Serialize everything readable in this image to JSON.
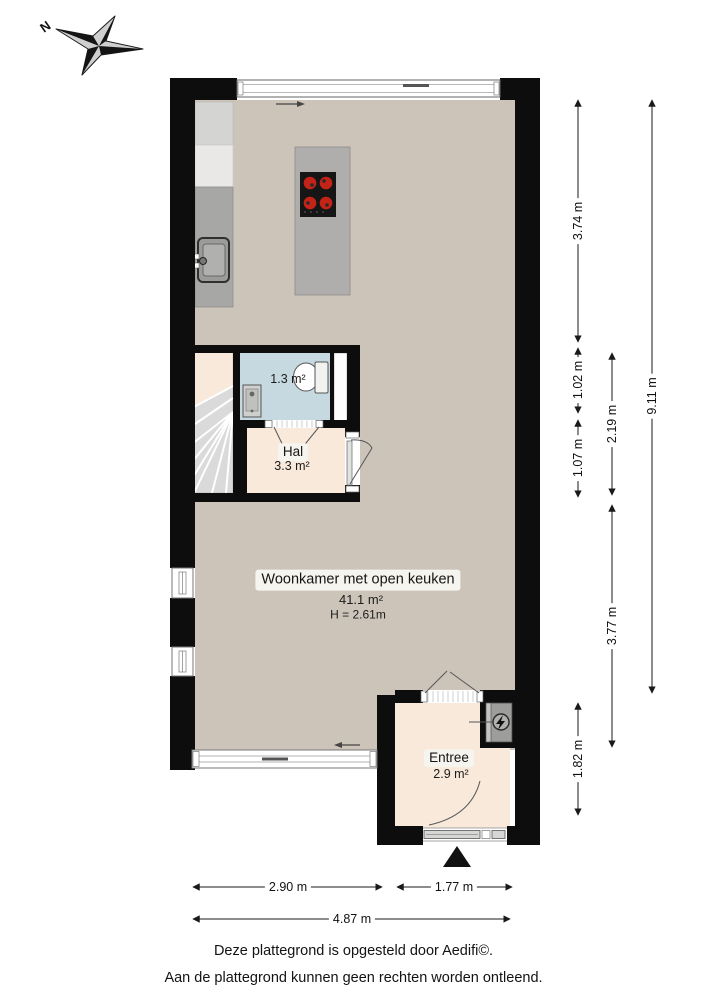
{
  "compass": {
    "north": "N"
  },
  "plan": {
    "rooms": {
      "woonkamer": {
        "label": "Woonkamer met open keuken",
        "area": "41.1 m²",
        "ceiling_height": "H = 2.61m"
      },
      "hal": {
        "label": "Hal",
        "area": "3.3 m²"
      },
      "toilet": {
        "area": "1.3 m²"
      },
      "entree": {
        "label": "Entree",
        "area": "2.9 m²"
      }
    },
    "fixtures": [
      "cooktop-island",
      "kitchen-sink",
      "kitchen-counter",
      "toilet",
      "hand-basin",
      "winder-stairs",
      "meter-cupboard",
      "entrance-marker"
    ],
    "colors": {
      "wall": "#0d0d0d",
      "floor_living": "#ccc3b9",
      "floor_hall": "#f8e9da",
      "floor_toilet": "#c6d9e0",
      "stairs": "#dadada",
      "counter": "#a7a7a5",
      "burner_red": "#c42318"
    }
  },
  "dimensions": {
    "right": [
      {
        "label": "3.74 m"
      },
      {
        "label": "1.02 m"
      },
      {
        "label": "1.07 m"
      },
      {
        "label": "1.82 m"
      },
      {
        "label": "2.19 m"
      },
      {
        "label": "3.77 m"
      },
      {
        "label": "9.11 m"
      }
    ],
    "bottom": [
      {
        "label": "2.90 m"
      },
      {
        "label": "1.77 m"
      },
      {
        "label": "4.87 m"
      }
    ]
  },
  "footer": {
    "line1": "Deze plattegrond is opgesteld door Aedifi©.",
    "line2": "Aan de plattegrond kunnen geen rechten worden ontleend."
  }
}
